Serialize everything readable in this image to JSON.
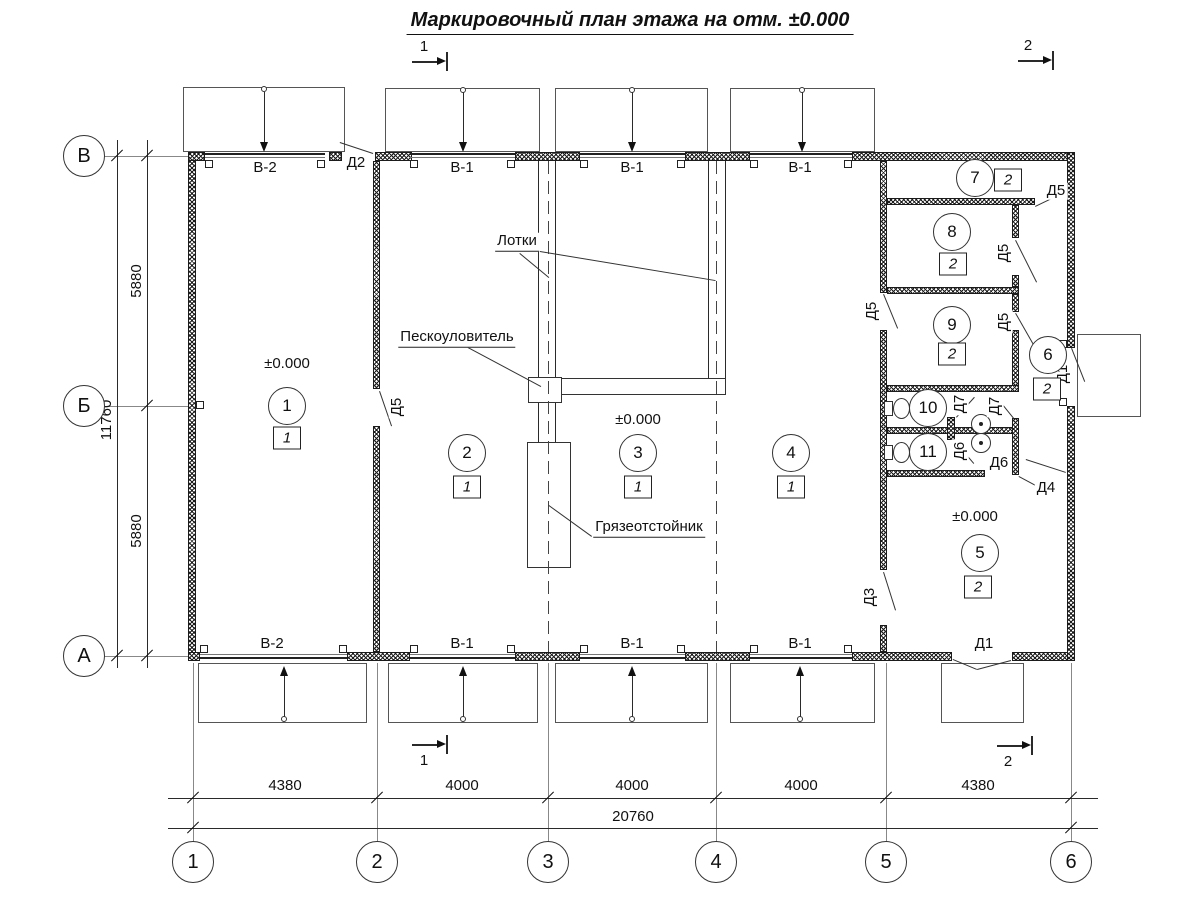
{
  "title": "Маркировочный план этажа на отм. ±0.000",
  "section_marks": {
    "top_1": "1",
    "top_2": "2",
    "bottom_1": "1",
    "bottom_2": "2"
  },
  "grid": {
    "cols": [
      "1",
      "2",
      "3",
      "4",
      "5",
      "6"
    ],
    "rows": [
      "В",
      "Б",
      "А"
    ]
  },
  "dims": {
    "bottom": [
      "4380",
      "4000",
      "4000",
      "4000",
      "4380"
    ],
    "bottom_total": "20760",
    "left": [
      "5880",
      "5880"
    ],
    "left_total": "11760"
  },
  "windows": {
    "top": [
      "В-2",
      "В-1",
      "В-1",
      "В-1"
    ],
    "bottom": [
      "В-2",
      "В-1",
      "В-1",
      "В-1"
    ]
  },
  "doors": {
    "d2": "Д2",
    "d5_partition": "Д5",
    "d5_room7": "Д5",
    "d5_room8": "Д5",
    "d5_hall": "Д5",
    "d5_room9": "Д5",
    "d1_right": "Д1",
    "d1_bottom": "Д1",
    "d3": "Д3",
    "d4": "Д4",
    "d6_stall": "Д6",
    "d6_lobby": "Д6",
    "d7_stall": "Д7",
    "d7_lobby": "Д7"
  },
  "rooms": [
    {
      "number": "1",
      "floor_type": "1"
    },
    {
      "number": "2",
      "floor_type": "1"
    },
    {
      "number": "3",
      "floor_type": "1"
    },
    {
      "number": "4",
      "floor_type": "1"
    },
    {
      "number": "5",
      "floor_type": "2"
    },
    {
      "number": "6",
      "floor_type": "2"
    },
    {
      "number": "7",
      "floor_type": "2"
    },
    {
      "number": "8",
      "floor_type": "2"
    },
    {
      "number": "9",
      "floor_type": "2"
    },
    {
      "number": "10"
    },
    {
      "number": "11"
    }
  ],
  "elevations": {
    "room1": "±0.000",
    "room3": "±0.000",
    "room5": "±0.000"
  },
  "annotations": {
    "trays": "Лотки",
    "sand_trap": "Пескоуловитель",
    "mud_settler": "Грязеотстойник"
  }
}
